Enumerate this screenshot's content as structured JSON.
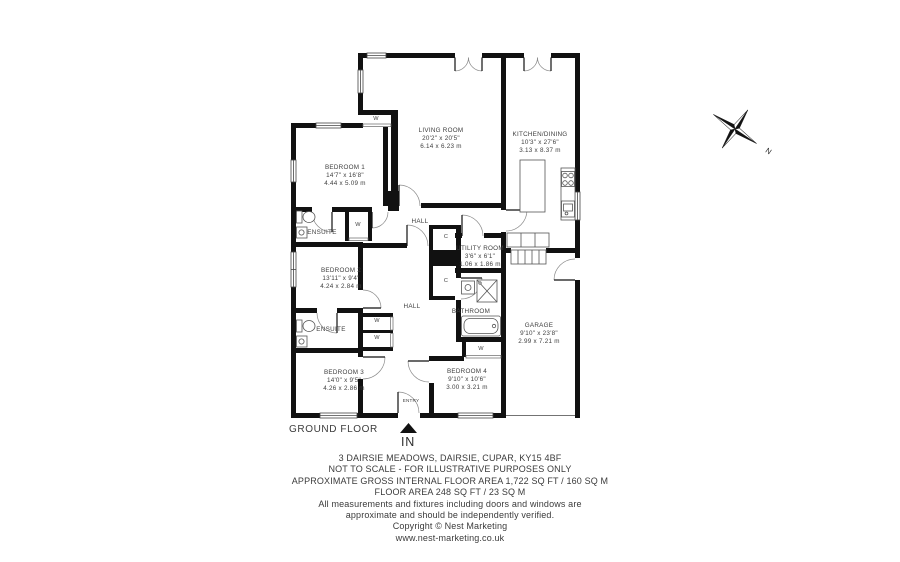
{
  "plan": {
    "floor_label": "GROUND FLOOR",
    "entry_label": "ENTRY",
    "entrance_label": "IN",
    "compass_north": "N",
    "rooms": [
      {
        "name": "LIVING ROOM",
        "imperial": "20'2\" x 20'5\"",
        "metric": "6.14 x 6.23 m"
      },
      {
        "name": "KITCHEN/DINING",
        "imperial": "10'3\" x 27'6\"",
        "metric": "3.13 x 8.37 m"
      },
      {
        "name": "BEDROOM 1",
        "imperial": "14'7\" x 16'8\"",
        "metric": "4.44 x 5.09 m"
      },
      {
        "name": "BEDROOM 2",
        "imperial": "13'11\" x 9'4\"",
        "metric": "4.24 x 2.84 m"
      },
      {
        "name": "BEDROOM 3",
        "imperial": "14'0\" x 9'5\"",
        "metric": "4.26 x 2.86 m"
      },
      {
        "name": "BEDROOM 4",
        "imperial": "9'10\" x 10'6\"",
        "metric": "3.00 x 3.21 m"
      },
      {
        "name": "GARAGE",
        "imperial": "9'10\" x 23'8\"",
        "metric": "2.99 x 7.21 m"
      },
      {
        "name": "UTILITY ROOM",
        "imperial": "3'6\" x 6'1\"",
        "metric": "1.06 x 1.86 m"
      }
    ],
    "areas": {
      "hall_upper": "HALL",
      "hall_lower": "HALL",
      "ensuite_upper": "ENSUITE",
      "ensuite_lower": "ENSUITE",
      "bathroom": "BATHROOM"
    },
    "storage": {
      "wardrobe": "W",
      "cupboard": "C"
    }
  },
  "footer": {
    "lines": [
      "3 DAIRSIE MEADOWS, DAIRSIE, CUPAR, KY15 4BF",
      "NOT TO SCALE - FOR ILLUSTRATIVE PURPOSES ONLY",
      "APPROXIMATE GROSS INTERNAL FLOOR AREA 1,722 SQ FT / 160 SQ M",
      "FLOOR AREA 248 SQ FT / 23 SQ M",
      "All measurements and fixtures including doors and windows are",
      "approximate and should be independently verified.",
      "Copyright © Nest Marketing",
      "www.nest-marketing.co.uk"
    ]
  },
  "colors": {
    "wall": "#111111",
    "label_text": "#3e3e3e",
    "thin_line": "#555555"
  }
}
